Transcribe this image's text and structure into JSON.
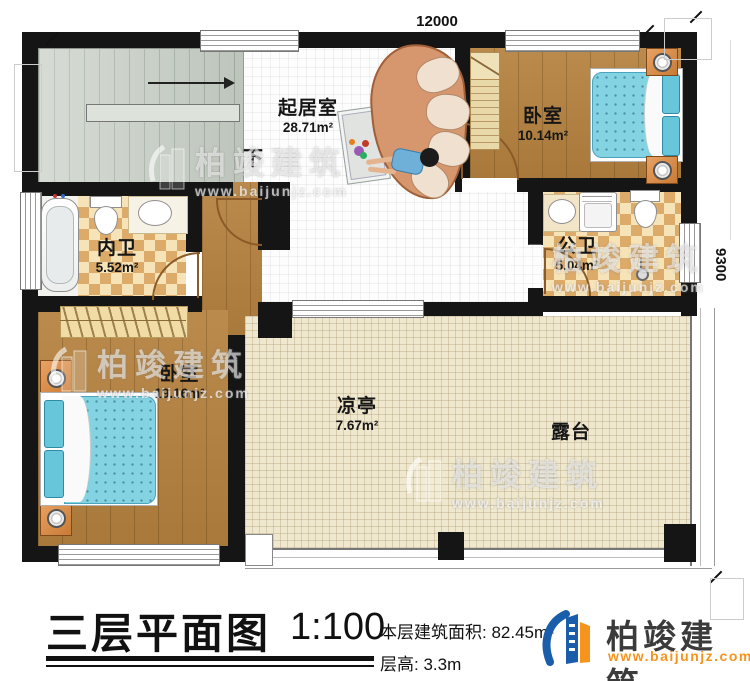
{
  "dimensions": {
    "width": "12000",
    "depth": "9300"
  },
  "stairs": {
    "direction": "下"
  },
  "rooms": {
    "living": {
      "name": "起居室",
      "area": "28.71m²"
    },
    "bedroom_top": {
      "name": "卧室",
      "area": "10.14m²"
    },
    "inner_bath": {
      "name": "内卫",
      "area": "5.52m²"
    },
    "public_bath": {
      "name": "公卫",
      "area": "5.04m²"
    },
    "bedroom_left": {
      "name": "卧室",
      "area": "19.16m²"
    },
    "pavilion": {
      "name": "凉亭",
      "area": "7.67m²"
    },
    "terrace": {
      "name": "露台"
    }
  },
  "title_block": {
    "plan_title": "三层平面图",
    "scale": "1:100",
    "floor_area_label": "本层建筑面积:",
    "floor_area_value": "82.45m²",
    "floor_height_label": "层高:",
    "floor_height_value": "3.3m"
  },
  "brand": {
    "name": "柏竣建筑",
    "website": "www.baijunjz.com"
  },
  "watermark": {
    "name": "柏竣建筑",
    "website": "www.baijunjz.com"
  },
  "colors": {
    "wall": "#151515",
    "wood": "#b5823f",
    "checker_dark": "#dcab69",
    "checker_light": "#f6e3b8",
    "terrace_floor": "#efe8cf",
    "stair_floor": "#c9d1c7",
    "bed_blue": "#84d3e2",
    "brand_blue": "#1a5dab",
    "brand_orange": "#f7941d"
  }
}
